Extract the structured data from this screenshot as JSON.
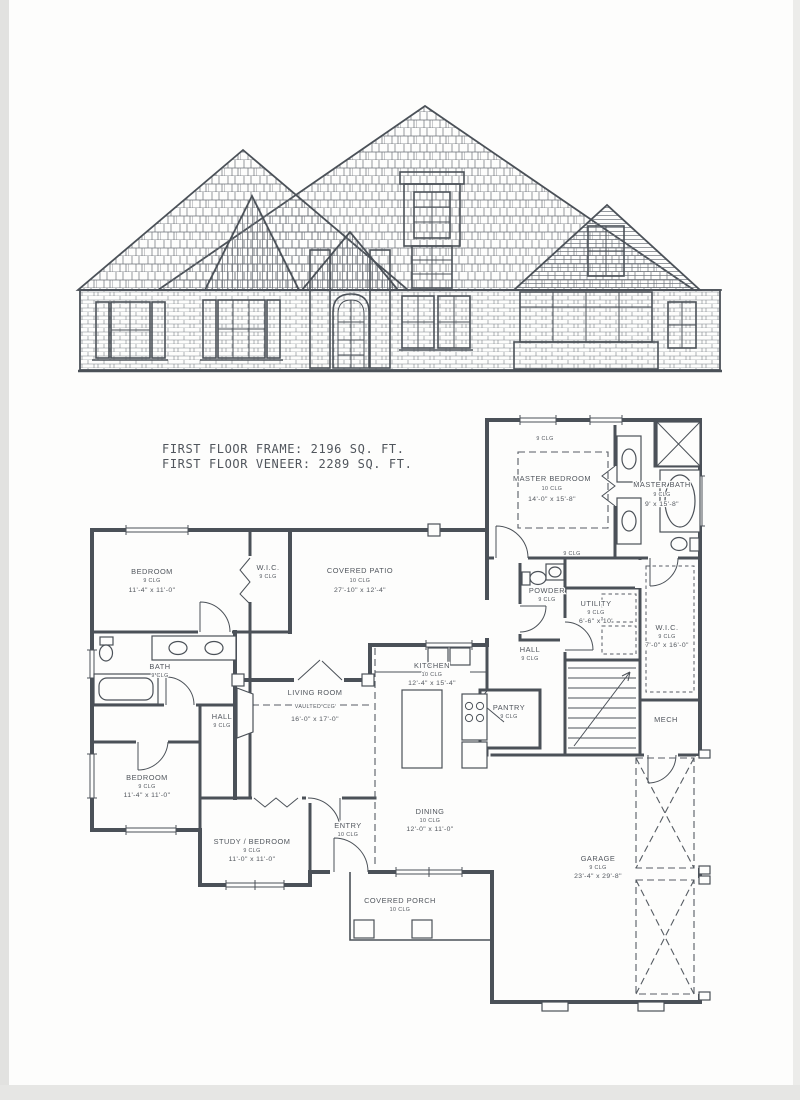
{
  "document": {
    "type_note": "scanned architectural sheet: front elevation above first-floor plan",
    "title_line1": "FIRST FLOOR FRAME: 2196 SQ. FT.",
    "title_line2": "FIRST FLOOR VENEER: 2289 SQ. FT."
  },
  "plan": {
    "rooms": {
      "master_bedroom": {
        "name": "MASTER BEDROOM",
        "clg": "10 CLG",
        "dims": "14'-0\" x 15'-8\""
      },
      "master_bath": {
        "name": "MASTER BATH",
        "clg": "9 CLG",
        "dims": "9' x 15'-8\""
      },
      "bedroom_tl": {
        "name": "BEDROOM",
        "clg": "9 CLG",
        "dims": "11'-4\" x 11'-0\""
      },
      "wic_tl": {
        "name": "W.I.C.",
        "clg": "9 CLG"
      },
      "covered_patio": {
        "name": "COVERED PATIO",
        "clg": "10 CLG",
        "dims": "27'-10\" x 12'-4\""
      },
      "powder": {
        "name": "POWDER",
        "clg": "9 CLG"
      },
      "utility": {
        "name": "UTILITY",
        "clg": "9 CLG",
        "dims": "6'-6\" x 10'"
      },
      "wic_r": {
        "name": "W.I.C.",
        "clg": "9 CLG",
        "dims": "7'-0\" x 16'-0\""
      },
      "hall_r": {
        "name": "HALL",
        "clg": "9 CLG"
      },
      "kitchen": {
        "name": "KITCHEN",
        "clg": "10 CLG",
        "dims": "12'-4\" x 15'-4\""
      },
      "bath": {
        "name": "BATH",
        "clg": "9 CLG"
      },
      "living": {
        "name": "LIVING ROOM",
        "clg": "VAULTED CLG",
        "dims": "16'-0\" x 17'-0\""
      },
      "hall_l": {
        "name": "HALL",
        "clg": "9 CLG"
      },
      "pantry": {
        "name": "PANTRY",
        "clg": "9 CLG"
      },
      "mech": {
        "name": "MECH"
      },
      "bedroom_bl": {
        "name": "BEDROOM",
        "clg": "9 CLG",
        "dims": "11'-4\" x 11'-0\""
      },
      "study": {
        "name": "STUDY / BEDROOM",
        "clg": "9 CLG",
        "dims": "11'-0\" x 11'-0\""
      },
      "entry": {
        "name": "ENTRY",
        "clg": "10 CLG"
      },
      "dining": {
        "name": "DINING",
        "clg": "10 CLG",
        "dims": "12'-0\" x 11'-0\""
      },
      "garage": {
        "name": "GARAGE",
        "clg": "9 CLG",
        "dims": "23'-4\" x 29'-8\""
      },
      "porch": {
        "name": "COVERED PORCH",
        "clg": "10 CLG"
      }
    },
    "notes": {
      "master_top": "9 CLG",
      "hall_top": "9 CLG"
    }
  },
  "colors": {
    "ink": "#4b5158",
    "paper": "#fdfdfc"
  }
}
